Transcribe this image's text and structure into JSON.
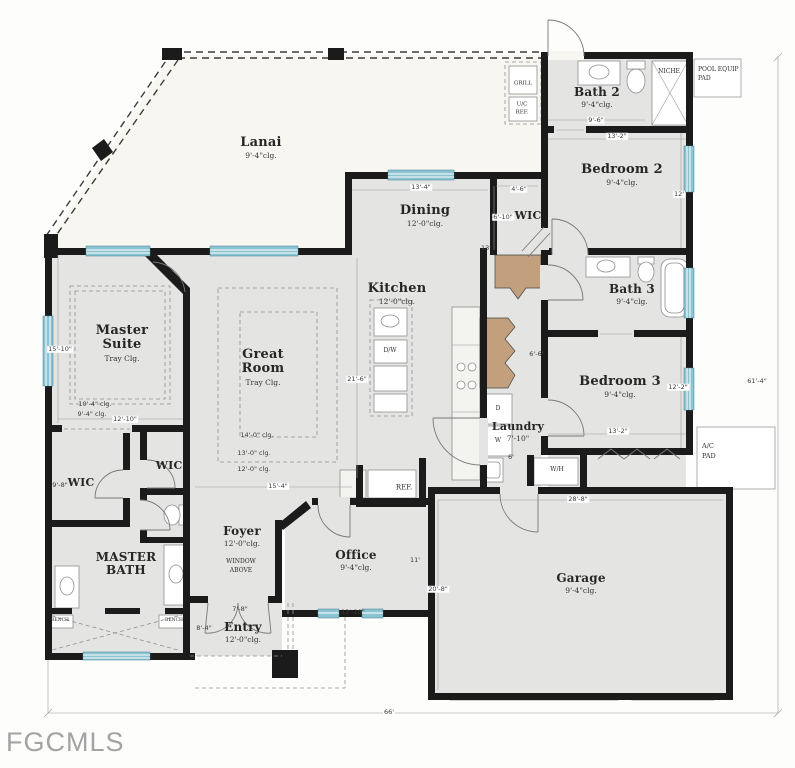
{
  "watermark": "FGCMLS",
  "colors": {
    "wall": "#1b1b1b",
    "floor": "#e4e4e2",
    "lanai": "#f7f6f0",
    "win": "#8cc4d2",
    "tan": "#c2a07e",
    "watermark": "#a3a3a3"
  },
  "rooms": [
    {
      "id": "lanai",
      "lines": [
        "Lanai"
      ],
      "sub": "9'-4\"clg.",
      "x": 261,
      "y": 136,
      "fs": 13
    },
    {
      "id": "bath-2",
      "lines": [
        "Bath 2"
      ],
      "sub": "9'-4\"clg.",
      "x": 597,
      "y": 86,
      "fs": 12
    },
    {
      "id": "bedroom-2",
      "lines": [
        "Bedroom 2"
      ],
      "sub": "9'-4\"clg.",
      "x": 622,
      "y": 163,
      "fs": 13
    },
    {
      "id": "dining",
      "lines": [
        "Dining"
      ],
      "sub": "12'-0\"clg.",
      "x": 425,
      "y": 204,
      "fs": 13
    },
    {
      "id": "wic-hall",
      "lines": [
        "WIC"
      ],
      "sub": "",
      "x": 528,
      "y": 210,
      "fs": 11
    },
    {
      "id": "kitchen",
      "lines": [
        "Kitchen"
      ],
      "sub": "12'-0\"clg.",
      "x": 397,
      "y": 282,
      "fs": 13
    },
    {
      "id": "bath-3",
      "lines": [
        "Bath 3"
      ],
      "sub": "9'-4\"clg.",
      "x": 632,
      "y": 283,
      "fs": 12
    },
    {
      "id": "bedroom-3",
      "lines": [
        "Bedroom 3"
      ],
      "sub": "9'-4\"clg.",
      "x": 620,
      "y": 375,
      "fs": 13
    },
    {
      "id": "master-suite",
      "lines": [
        "Master",
        "Suite"
      ],
      "sub": "Tray Clg.",
      "x": 122,
      "y": 324,
      "fs": 13
    },
    {
      "id": "great-room",
      "lines": [
        "Great",
        "Room"
      ],
      "sub": "Tray Clg.",
      "x": 263,
      "y": 348,
      "fs": 13
    },
    {
      "id": "laundry",
      "lines": [
        "Laundry"
      ],
      "sub": "7'-10\"",
      "x": 518,
      "y": 421,
      "fs": 11
    },
    {
      "id": "wic-left",
      "lines": [
        "WIC"
      ],
      "sub": "",
      "x": 81,
      "y": 477,
      "fs": 11
    },
    {
      "id": "wic-right",
      "lines": [
        "WIC"
      ],
      "sub": "",
      "x": 169,
      "y": 460,
      "fs": 11
    },
    {
      "id": "master-bath",
      "lines": [
        "MASTER",
        "BATH"
      ],
      "sub": "",
      "x": 126,
      "y": 551,
      "fs": 12
    },
    {
      "id": "foyer",
      "lines": [
        "Foyer"
      ],
      "sub": "12'-0\"clg.",
      "x": 242,
      "y": 525,
      "fs": 12
    },
    {
      "id": "office",
      "lines": [
        "Office"
      ],
      "sub": "9'-4\"clg.",
      "x": 356,
      "y": 549,
      "fs": 12
    },
    {
      "id": "entry",
      "lines": [
        "Entry"
      ],
      "sub": "12'-0\"clg.",
      "x": 243,
      "y": 621,
      "fs": 12
    },
    {
      "id": "garage",
      "lines": [
        "Garage"
      ],
      "sub": "9'-4\"clg.",
      "x": 581,
      "y": 572,
      "fs": 12
    }
  ],
  "dimensions": [
    {
      "t": "9'-6\"",
      "x": 596,
      "y": 120,
      "bg": 1
    },
    {
      "t": "13'-2\"",
      "x": 617,
      "y": 136,
      "bg": 1
    },
    {
      "t": "12'",
      "x": 679,
      "y": 194,
      "bg": 1
    },
    {
      "t": "13'-4\"",
      "x": 421,
      "y": 187,
      "bg": 1
    },
    {
      "t": "4'-6\"",
      "x": 519,
      "y": 189,
      "bg": 1
    },
    {
      "t": "6'-10\"",
      "x": 503,
      "y": 217,
      "bg": 1
    },
    {
      "t": "13'",
      "x": 486,
      "y": 248
    },
    {
      "t": "12'-2\"",
      "x": 678,
      "y": 387,
      "bg": 1
    },
    {
      "t": "13'-2\"",
      "x": 618,
      "y": 431,
      "bg": 1
    },
    {
      "t": "15'-10\"",
      "x": 60,
      "y": 349,
      "bg": 1
    },
    {
      "t": "10'-4\" clg.",
      "x": 95,
      "y": 404
    },
    {
      "t": "9'-4\" clg.",
      "x": 92,
      "y": 414
    },
    {
      "t": "12'-10\"",
      "x": 125,
      "y": 419,
      "bg": 1
    },
    {
      "t": "21'-6\"",
      "x": 357,
      "y": 379,
      "bg": 1
    },
    {
      "t": "14'-0\" clg.",
      "x": 257,
      "y": 435
    },
    {
      "t": "13'-0\" clg.",
      "x": 254,
      "y": 453
    },
    {
      "t": "12'-0\" clg.",
      "x": 254,
      "y": 469
    },
    {
      "t": "6'-6\"",
      "x": 537,
      "y": 354
    },
    {
      "t": "6'",
      "x": 511,
      "y": 457
    },
    {
      "t": "9'-8\"",
      "x": 60,
      "y": 485
    },
    {
      "t": "8'-4\"",
      "x": 204,
      "y": 628
    },
    {
      "t": "7'-8\"",
      "x": 240,
      "y": 609
    },
    {
      "t": "15'-4\"",
      "x": 278,
      "y": 486,
      "bg": 1
    },
    {
      "t": "11'",
      "x": 415,
      "y": 560
    },
    {
      "t": "12'-10\"",
      "x": 353,
      "y": 612
    },
    {
      "t": "28'-8\"",
      "x": 578,
      "y": 499,
      "bg": 1
    },
    {
      "t": "20'-8\"",
      "x": 438,
      "y": 589,
      "bg": 1
    },
    {
      "t": "61'-4\"",
      "x": 757,
      "y": 381
    },
    {
      "t": "66'",
      "x": 389,
      "y": 712,
      "bg": 1
    }
  ],
  "fixtures": [
    {
      "id": "grill",
      "t": "GRILL",
      "x": 523,
      "y": 84,
      "fs": 5.5
    },
    {
      "id": "uc-ref-1",
      "t": "U/C",
      "x": 522,
      "y": 105,
      "fs": 5.5
    },
    {
      "id": "uc-ref-2",
      "t": "REF.",
      "x": 522,
      "y": 113,
      "fs": 5.5
    },
    {
      "id": "niche",
      "t": "NICHE",
      "x": 669,
      "y": 72,
      "fs": 6
    },
    {
      "id": "pool-pad-1",
      "t": "POOL EQUIP",
      "x": 698,
      "y": 70,
      "fs": 6,
      "ta": "l"
    },
    {
      "id": "pool-pad-2",
      "t": "PAD",
      "x": 698,
      "y": 79,
      "fs": 6,
      "ta": "l"
    },
    {
      "id": "ac-pad-1",
      "t": "A/C",
      "x": 702,
      "y": 446,
      "fs": 6.5,
      "ta": "l"
    },
    {
      "id": "ac-pad-2",
      "t": "PAD",
      "x": 702,
      "y": 456,
      "fs": 6.5,
      "ta": "l"
    },
    {
      "id": "water-heater",
      "t": "W/H",
      "x": 557,
      "y": 470,
      "fs": 6
    },
    {
      "id": "fridge",
      "t": "REF.",
      "x": 404,
      "y": 488,
      "fs": 7
    },
    {
      "id": "dishwasher",
      "t": "D/W",
      "x": 390,
      "y": 351,
      "fs": 6
    },
    {
      "id": "dryer",
      "t": "D",
      "x": 498,
      "y": 409,
      "fs": 6
    },
    {
      "id": "washer",
      "t": "W",
      "x": 498,
      "y": 441,
      "fs": 6
    },
    {
      "id": "bench-left",
      "t": "BENCH",
      "x": 60,
      "y": 621,
      "fs": 4.5
    },
    {
      "id": "bench-right",
      "t": "BENCH",
      "x": 174,
      "y": 621,
      "fs": 4.5
    },
    {
      "id": "window-above-1",
      "t": "WINDOW",
      "x": 241,
      "y": 562,
      "fs": 6
    },
    {
      "id": "window-above-2",
      "t": "ABOVE",
      "x": 241,
      "y": 571,
      "fs": 6
    }
  ]
}
